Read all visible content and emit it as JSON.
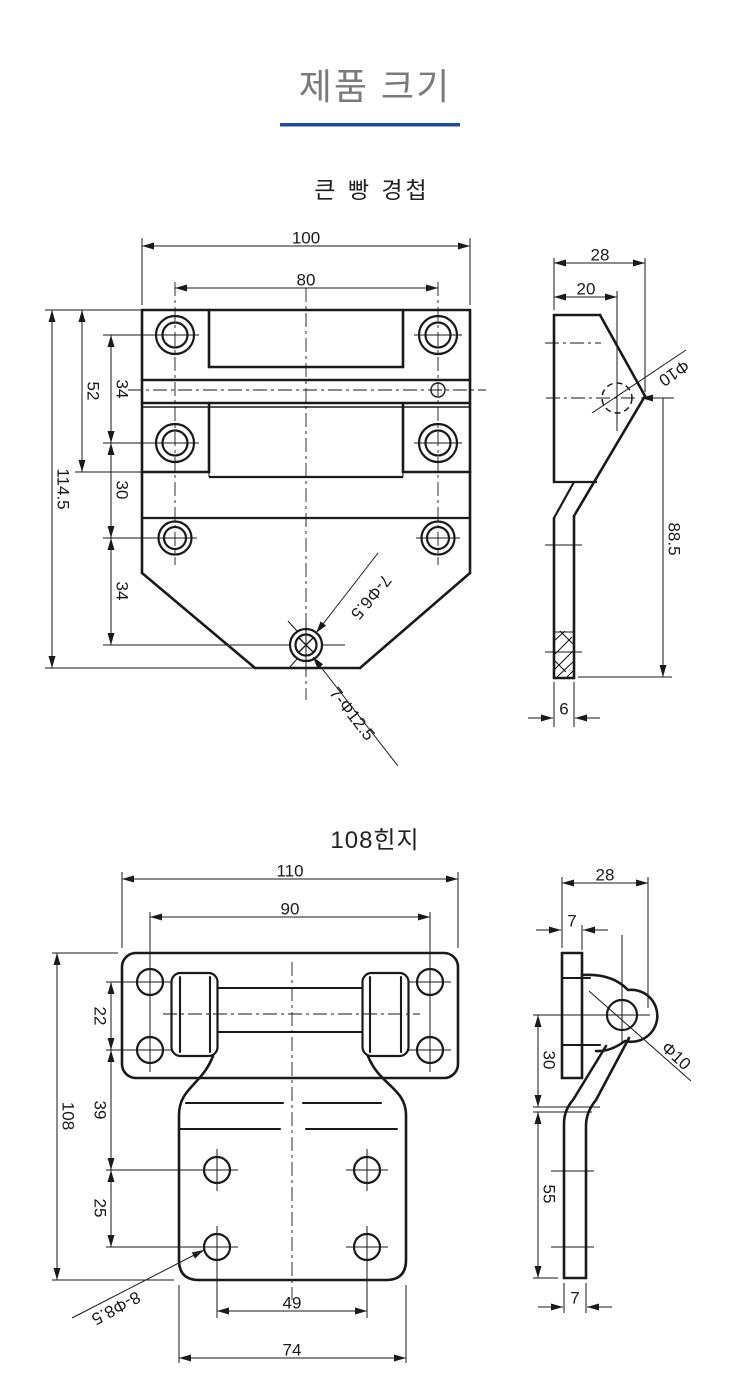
{
  "page": {
    "title": "제품 크기",
    "accent_color": "#1d4b9e",
    "title_color": "#7a7a7a",
    "line_color": "#1a1a1a"
  },
  "d1": {
    "title": "큰 빵 경첩",
    "front": {
      "w": "100",
      "span": "80",
      "h1": "52",
      "g1": "34",
      "g2": "30",
      "g3": "34",
      "ht": "114.5",
      "note_small": "7-Φ6.5",
      "note_large": "7-Φ12.5"
    },
    "side": {
      "depth": "28",
      "pin_off": "20",
      "dia": "Φ10",
      "leg": "88.5",
      "t": "6"
    }
  },
  "d2": {
    "title": "108힌지",
    "front": {
      "w": "110",
      "span": "90",
      "g1": "22",
      "g2": "39",
      "g3": "25",
      "ht": "108",
      "bspan": "49",
      "bw": "74",
      "note": "8-Φ8.5"
    },
    "side": {
      "depth": "28",
      "t_top": "7",
      "dia": "Φ10",
      "upper": "30",
      "leg": "55",
      "t_bot": "7"
    }
  }
}
